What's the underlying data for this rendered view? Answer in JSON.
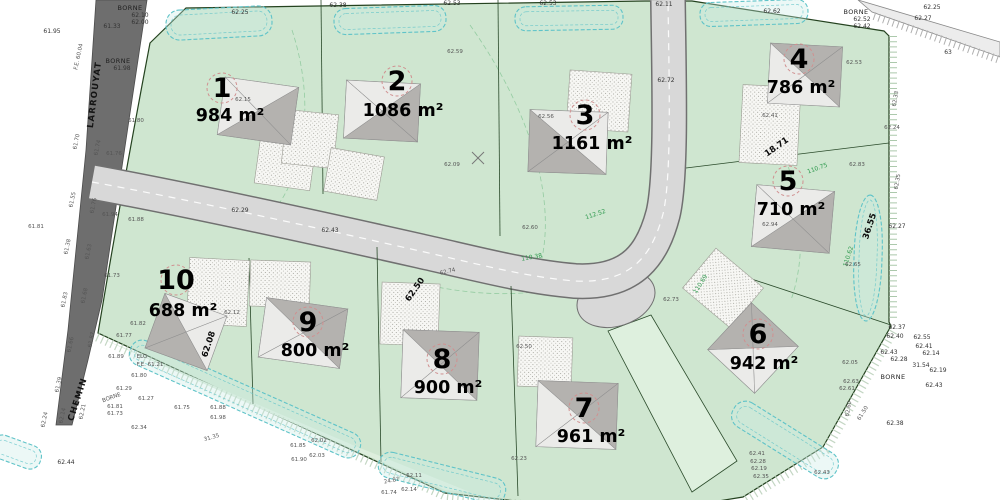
{
  "map": {
    "colors": {
      "parcel_green": "#cfe6d0",
      "parcel_green_light": "#ddeedd",
      "road_fill": "#d8d8d8",
      "road_casing": "#707070",
      "street_dark": "#6e6e6e",
      "hedge_cyan": "#5fc3c8",
      "house_light": "#ebebe9",
      "house_dark": "#b4b2af",
      "boundary": "#24421f",
      "lot_circle": "#d09090"
    },
    "road_names": [
      {
        "t": "LARROUYAT",
        "x": 97,
        "y": 95,
        "r": -83
      },
      {
        "t": "CHEMIN",
        "x": 80,
        "y": 400,
        "r": -72
      }
    ],
    "lots": [
      {
        "number": "1",
        "area": "984 m²",
        "nx": 222,
        "ny": 97,
        "ax": 230,
        "ay": 121
      },
      {
        "number": "2",
        "area": "1086 m²",
        "nx": 397,
        "ny": 90,
        "ax": 403,
        "ay": 116
      },
      {
        "number": "3",
        "area": "1161 m²",
        "nx": 585,
        "ny": 124,
        "ax": 592,
        "ay": 149
      },
      {
        "number": "4",
        "area": "786 m²",
        "nx": 799,
        "ny": 68,
        "ax": 801,
        "ay": 93
      },
      {
        "number": "5",
        "area": "710 m²",
        "nx": 788,
        "ny": 190,
        "ax": 791,
        "ay": 215
      },
      {
        "number": "6",
        "area": "942 m²",
        "nx": 758,
        "ny": 343,
        "ax": 764,
        "ay": 369
      },
      {
        "number": "7",
        "area": "961 m²",
        "nx": 584,
        "ny": 417,
        "ax": 591,
        "ay": 442
      },
      {
        "number": "8",
        "area": "900 m²",
        "nx": 442,
        "ny": 368,
        "ax": 448,
        "ay": 393
      },
      {
        "number": "9",
        "area": "800 m²",
        "nx": 308,
        "ny": 331,
        "ax": 315,
        "ay": 356
      },
      {
        "number": "10",
        "area": "688 m²",
        "nx": 176,
        "ny": 289,
        "ax": 183,
        "ay": 316
      }
    ],
    "labels": [
      {
        "t": "BORNE",
        "x": 130,
        "y": 10,
        "k": "borne"
      },
      {
        "t": "62.10",
        "x": 140,
        "y": 17,
        "k": "sm"
      },
      {
        "t": "62.00",
        "x": 140,
        "y": 24,
        "k": "sm"
      },
      {
        "t": "BORNE",
        "x": 118,
        "y": 63,
        "k": "borne"
      },
      {
        "t": "61.98",
        "x": 122,
        "y": 70,
        "k": "sm"
      },
      {
        "t": "61.95",
        "x": 52,
        "y": 33,
        "k": "sm"
      },
      {
        "t": "61.33",
        "x": 112,
        "y": 28,
        "k": "sm"
      },
      {
        "t": "F.E. 60.04",
        "x": 80,
        "y": 57,
        "r": -78,
        "k": "gy"
      },
      {
        "t": "61.70",
        "x": 78,
        "y": 142,
        "r": -78,
        "k": "gy"
      },
      {
        "t": "61.74",
        "x": 99,
        "y": 148,
        "r": -78,
        "k": "gy"
      },
      {
        "t": "61.55",
        "x": 74,
        "y": 200,
        "r": -78,
        "k": "gy"
      },
      {
        "t": "61.76",
        "x": 95,
        "y": 206,
        "r": -78,
        "k": "gy"
      },
      {
        "t": "61.81",
        "x": 36,
        "y": 228,
        "k": "gy"
      },
      {
        "t": "61.38",
        "x": 69,
        "y": 247,
        "r": -78,
        "k": "gy"
      },
      {
        "t": "61.63",
        "x": 90,
        "y": 252,
        "r": -78,
        "k": "gy"
      },
      {
        "t": "61.68",
        "x": 86,
        "y": 296,
        "r": -78,
        "k": "gy"
      },
      {
        "t": "61.83",
        "x": 66,
        "y": 300,
        "r": -78,
        "k": "gy"
      },
      {
        "t": "61.87",
        "x": 93,
        "y": 340,
        "r": -78,
        "k": "gy"
      },
      {
        "t": "61.66",
        "x": 72,
        "y": 345,
        "r": -78,
        "k": "gy"
      },
      {
        "t": "61.39",
        "x": 60,
        "y": 385,
        "r": -78,
        "k": "gy"
      },
      {
        "t": "62.14",
        "x": 64,
        "y": 416,
        "r": -78,
        "k": "gy"
      },
      {
        "t": "62.21",
        "x": 84,
        "y": 412,
        "r": -78,
        "k": "gy"
      },
      {
        "t": "62.24",
        "x": 46,
        "y": 420,
        "r": -78,
        "k": "gy"
      },
      {
        "t": "62.25",
        "x": 240,
        "y": 14,
        "k": "sm"
      },
      {
        "t": "62.38",
        "x": 338,
        "y": 7,
        "k": "sm"
      },
      {
        "t": "62.53",
        "x": 452,
        "y": 5,
        "k": "sm"
      },
      {
        "t": "62.53",
        "x": 548,
        "y": 5,
        "k": "sm"
      },
      {
        "t": "62.11",
        "x": 664,
        "y": 6,
        "k": "sm"
      },
      {
        "t": "62.62",
        "x": 772,
        "y": 13,
        "k": "sm"
      },
      {
        "t": "BORNE",
        "x": 856,
        "y": 14,
        "k": "borne"
      },
      {
        "t": "62.52",
        "x": 862,
        "y": 21,
        "k": "sm"
      },
      {
        "t": "62.42",
        "x": 862,
        "y": 28,
        "k": "sm"
      },
      {
        "t": "62.25",
        "x": 932,
        "y": 9,
        "k": "sm"
      },
      {
        "t": "62.27",
        "x": 923,
        "y": 20,
        "k": "sm"
      },
      {
        "t": "63",
        "x": 948,
        "y": 54,
        "k": "sm"
      },
      {
        "t": "62.15",
        "x": 243,
        "y": 101,
        "k": "gy"
      },
      {
        "t": "61.80",
        "x": 136,
        "y": 122,
        "k": "gy"
      },
      {
        "t": "61.76",
        "x": 114,
        "y": 155,
        "k": "gy"
      },
      {
        "t": "62.59",
        "x": 455,
        "y": 53,
        "k": "gy"
      },
      {
        "t": "62.09",
        "x": 452,
        "y": 166,
        "k": "gy"
      },
      {
        "t": "62.56",
        "x": 546,
        "y": 118,
        "k": "gy"
      },
      {
        "t": "62.72",
        "x": 666,
        "y": 82,
        "k": "sm"
      },
      {
        "t": "62.29",
        "x": 240,
        "y": 212,
        "k": "sm"
      },
      {
        "t": "62.43",
        "x": 330,
        "y": 232,
        "k": "sm"
      },
      {
        "t": "61.94",
        "x": 110,
        "y": 216,
        "k": "gy"
      },
      {
        "t": "61.88",
        "x": 136,
        "y": 221,
        "k": "gy"
      },
      {
        "t": "61.73",
        "x": 112,
        "y": 277,
        "k": "gy"
      },
      {
        "t": "62.74",
        "x": 448,
        "y": 273,
        "r": -14,
        "k": "gy"
      },
      {
        "t": "62.53",
        "x": 854,
        "y": 64,
        "k": "gy"
      },
      {
        "t": "62.41",
        "x": 770,
        "y": 117,
        "k": "gy"
      },
      {
        "t": "18.71",
        "x": 778,
        "y": 149,
        "r": -35,
        "k": "dim"
      },
      {
        "t": "110.75",
        "x": 818,
        "y": 170,
        "r": -20,
        "k": "gr"
      },
      {
        "t": "62.83",
        "x": 857,
        "y": 166,
        "k": "gy"
      },
      {
        "t": "62.94",
        "x": 770,
        "y": 226,
        "k": "gy"
      },
      {
        "t": "36.55",
        "x": 872,
        "y": 227,
        "r": -72,
        "k": "dim"
      },
      {
        "t": "62.27",
        "x": 897,
        "y": 228,
        "k": "sm"
      },
      {
        "t": "110.62",
        "x": 850,
        "y": 257,
        "r": -72,
        "k": "gr"
      },
      {
        "t": "62.65",
        "x": 853,
        "y": 266,
        "k": "gy"
      },
      {
        "t": "62.24",
        "x": 892,
        "y": 129,
        "k": "gy"
      },
      {
        "t": "62.33",
        "x": 897,
        "y": 99,
        "r": -80,
        "k": "gy"
      },
      {
        "t": "62.35",
        "x": 899,
        "y": 182,
        "r": -80,
        "k": "gy"
      },
      {
        "t": "112.52",
        "x": 596,
        "y": 216,
        "r": -18,
        "k": "gr"
      },
      {
        "t": "62.60",
        "x": 530,
        "y": 229,
        "k": "gy"
      },
      {
        "t": "110.38",
        "x": 532,
        "y": 259,
        "r": -10,
        "k": "gr"
      },
      {
        "t": "62.73",
        "x": 671,
        "y": 301,
        "k": "gy"
      },
      {
        "t": "110.69",
        "x": 702,
        "y": 285,
        "r": -58,
        "k": "gr"
      },
      {
        "t": "62.37",
        "x": 897,
        "y": 329,
        "k": "sm"
      },
      {
        "t": "62.40",
        "x": 895,
        "y": 338,
        "k": "sm"
      },
      {
        "t": "62.55",
        "x": 922,
        "y": 339,
        "k": "sm"
      },
      {
        "t": "62.41",
        "x": 924,
        "y": 348,
        "k": "sm"
      },
      {
        "t": "62.14",
        "x": 931,
        "y": 355,
        "k": "sm"
      },
      {
        "t": "62.43",
        "x": 889,
        "y": 354,
        "k": "sm"
      },
      {
        "t": "62.28",
        "x": 899,
        "y": 361,
        "k": "sm"
      },
      {
        "t": "31.54",
        "x": 921,
        "y": 367,
        "k": "sm"
      },
      {
        "t": "62.19",
        "x": 938,
        "y": 372,
        "k": "sm"
      },
      {
        "t": "BORNE",
        "x": 893,
        "y": 379,
        "k": "borne"
      },
      {
        "t": "62.43",
        "x": 934,
        "y": 387,
        "k": "sm"
      },
      {
        "t": "62.38",
        "x": 895,
        "y": 425,
        "k": "sm"
      },
      {
        "t": "62.05",
        "x": 850,
        "y": 364,
        "k": "gy"
      },
      {
        "t": "62.63",
        "x": 851,
        "y": 383,
        "k": "gy"
      },
      {
        "t": "62.61",
        "x": 847,
        "y": 390,
        "k": "gy"
      },
      {
        "t": "62.60",
        "x": 850,
        "y": 409,
        "r": -80,
        "k": "gy"
      },
      {
        "t": "61.50",
        "x": 864,
        "y": 414,
        "r": -58,
        "k": "gy"
      },
      {
        "t": "62.43",
        "x": 822,
        "y": 474,
        "k": "gy"
      },
      {
        "t": "62.41",
        "x": 757,
        "y": 455,
        "k": "gy"
      },
      {
        "t": "62.28",
        "x": 758,
        "y": 463,
        "k": "gy"
      },
      {
        "t": "62.19",
        "x": 759,
        "y": 470,
        "k": "gy"
      },
      {
        "t": "62.35",
        "x": 761,
        "y": 478,
        "k": "gy"
      },
      {
        "t": "62.50",
        "x": 524,
        "y": 348,
        "k": "gy"
      },
      {
        "t": "62.23",
        "x": 519,
        "y": 460,
        "k": "gy"
      },
      {
        "t": "62.50",
        "x": 417,
        "y": 291,
        "r": -55,
        "k": "dim"
      },
      {
        "t": "62.12",
        "x": 232,
        "y": 314,
        "k": "gy"
      },
      {
        "t": "62.08",
        "x": 211,
        "y": 345,
        "r": -72,
        "k": "dim"
      },
      {
        "t": "61.82",
        "x": 138,
        "y": 325,
        "k": "gy"
      },
      {
        "t": "61.77",
        "x": 124,
        "y": 337,
        "k": "gy"
      },
      {
        "t": "61.89",
        "x": 116,
        "y": 358,
        "k": "gy"
      },
      {
        "t": "ELO",
        "x": 142,
        "y": 358,
        "k": "gy"
      },
      {
        "t": "F.E. 61.21",
        "x": 150,
        "y": 366,
        "k": "gy"
      },
      {
        "t": "61.80",
        "x": 139,
        "y": 377,
        "k": "gy"
      },
      {
        "t": "61.29",
        "x": 124,
        "y": 390,
        "k": "gy"
      },
      {
        "t": "61.27",
        "x": 146,
        "y": 400,
        "k": "gy"
      },
      {
        "t": "BORNE",
        "x": 112,
        "y": 399,
        "r": -20,
        "k": "gy"
      },
      {
        "t": "61.81",
        "x": 115,
        "y": 408,
        "k": "gy"
      },
      {
        "t": "61.73",
        "x": 115,
        "y": 415,
        "k": "gy"
      },
      {
        "t": "62.34",
        "x": 139,
        "y": 429,
        "k": "gy"
      },
      {
        "t": "62.44",
        "x": 66,
        "y": 464,
        "k": "sm"
      },
      {
        "t": "61.75",
        "x": 182,
        "y": 409,
        "k": "gy"
      },
      {
        "t": "61.88",
        "x": 218,
        "y": 409,
        "k": "gy"
      },
      {
        "t": "61.98",
        "x": 218,
        "y": 419,
        "k": "gy"
      },
      {
        "t": "31.35",
        "x": 212,
        "y": 439,
        "r": -16,
        "k": "gy"
      },
      {
        "t": "61.85",
        "x": 298,
        "y": 447,
        "k": "gy"
      },
      {
        "t": "62.02",
        "x": 319,
        "y": 442,
        "k": "gy"
      },
      {
        "t": "61.90",
        "x": 299,
        "y": 461,
        "k": "gy"
      },
      {
        "t": "62.03",
        "x": 317,
        "y": 457,
        "k": "gy"
      },
      {
        "t": "24.87",
        "x": 392,
        "y": 482,
        "r": -12,
        "k": "gy"
      },
      {
        "t": "62.11",
        "x": 414,
        "y": 477,
        "k": "gy"
      },
      {
        "t": "62.14",
        "x": 409,
        "y": 491,
        "k": "gy"
      },
      {
        "t": "61.74",
        "x": 389,
        "y": 494,
        "k": "gy"
      }
    ]
  }
}
